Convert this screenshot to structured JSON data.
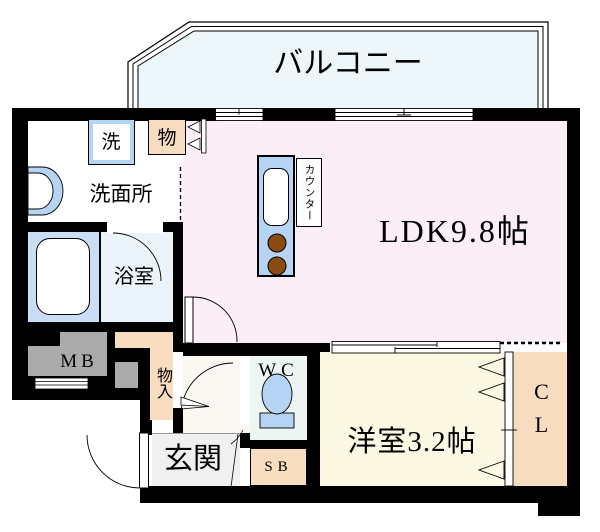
{
  "floorplan": {
    "balcony": {
      "label": "バルコニー"
    },
    "ldk": {
      "label": "LDK9.8帖"
    },
    "western_room": {
      "label": "洋室3.2帖"
    },
    "closet": {
      "label": "CL"
    },
    "shoe_box": {
      "label": "SB"
    },
    "wc": {
      "label": "WC"
    },
    "entrance": {
      "label": "玄関"
    },
    "hall_storage": {
      "label": "物入"
    },
    "meter_box": {
      "label": "MB"
    },
    "washroom": {
      "label": "洗面所"
    },
    "washer": {
      "label": "洗"
    },
    "bathroom": {
      "label": "浴室"
    },
    "storage": {
      "label": "物"
    },
    "counter": {
      "label": "カウンター"
    }
  },
  "colors": {
    "wall": "#000000",
    "ldk_floor": "#fceef6",
    "western_room_floor": "#fbf9e4",
    "closet_peach": "#f8dcc0",
    "fixture_blue": "#b5d3f2",
    "tub_zone_blue": "#c9def6",
    "balcony_fill": "#edf6f9",
    "meter_box_gray": "#ababab",
    "burner_brown": "#8a4a10",
    "entrance_gray": "#f0f0f0"
  }
}
